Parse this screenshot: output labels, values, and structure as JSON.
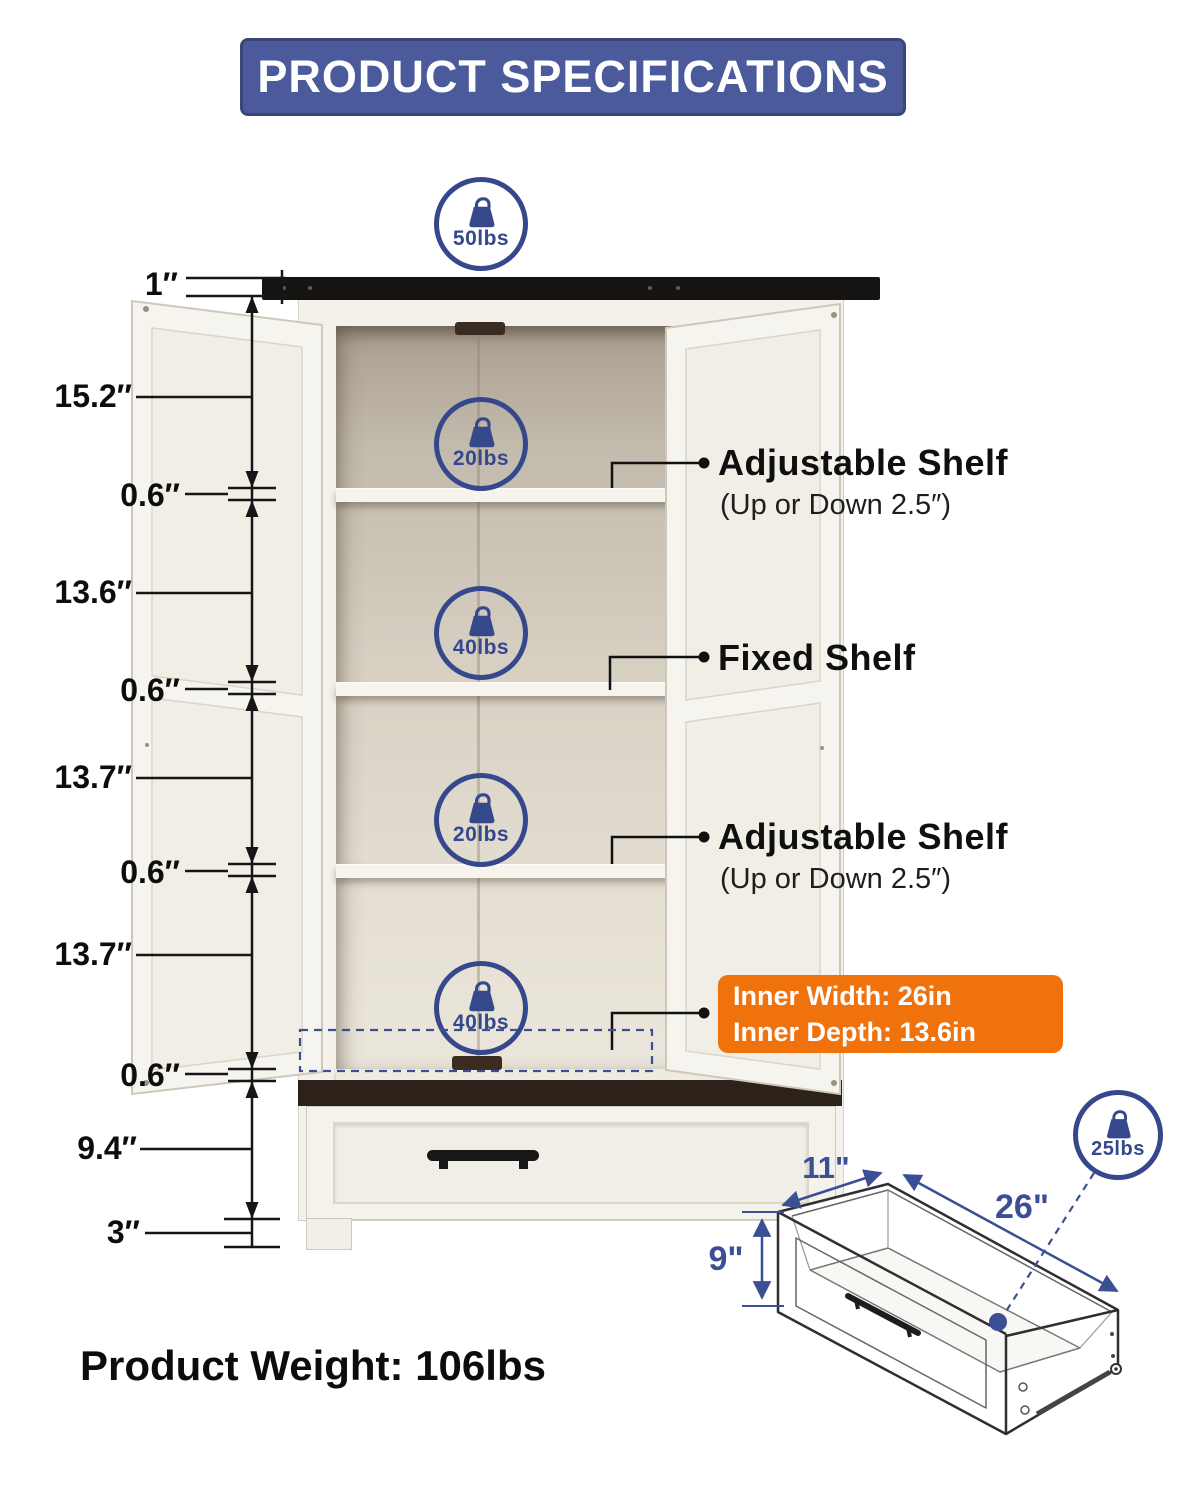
{
  "title": "PRODUCT SPECIFICATIONS",
  "product_weight": "Product Weight: 106lbs",
  "badges": {
    "top": "50lbs",
    "compartment1": "20lbs",
    "compartment2": "40lbs",
    "compartment3": "20lbs",
    "compartment4": "40lbs",
    "drawer": "25lbs"
  },
  "left_dims": [
    "1″",
    "15.2″",
    "0.6″",
    "13.6″",
    "0.6″",
    "13.7″",
    "0.6″",
    "13.7″",
    "0.6″",
    "9.4″",
    "3″"
  ],
  "right_labels": {
    "adjustable_top_title": "Adjustable Shelf",
    "adjustable_top_sub": "(Up or Down 2.5″)",
    "fixed_title": "Fixed Shelf",
    "adjustable_bottom_title": "Adjustable Shelf",
    "adjustable_bottom_sub": "(Up or Down 2.5″)"
  },
  "inner_box": {
    "line1": "Inner Width: 26in",
    "line2": "Inner Depth: 13.6in"
  },
  "drawer_dims": {
    "depth": "11\"",
    "width": "26\"",
    "height": "9\""
  },
  "colors": {
    "banner_blue": "#4a5a9b",
    "badge_blue": "#35488c",
    "dim_line_blue": "#3b4f94",
    "accent_orange": "#f0720d",
    "cabinet_white": "#f5f2ec",
    "top_slab_black": "#161412"
  }
}
